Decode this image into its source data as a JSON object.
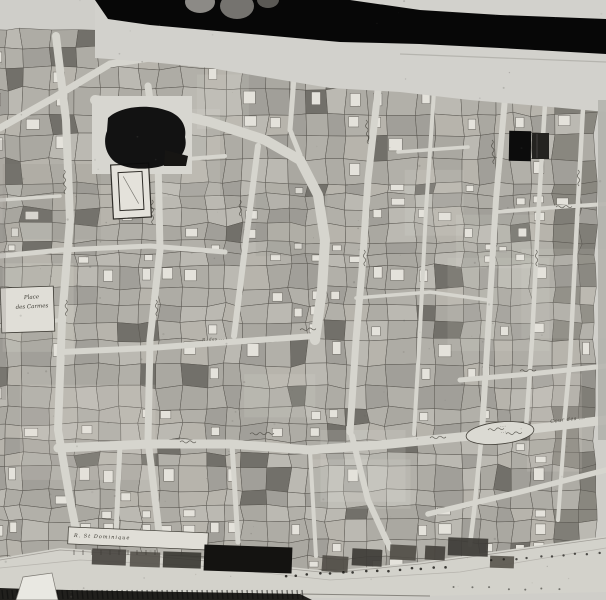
{
  "photo": {
    "description": "Black-and-white photograph of a hand-drawn historical cadastral town plan; a dark band and fingertips obscure the top edge",
    "obstructions": [
      "photo-band-top",
      "fingertips",
      "censor-patch-upper-left",
      "censor-patch-upper-right",
      "censor-patch-bottom"
    ]
  },
  "labels": {
    "place": {
      "line1": "Place",
      "line2": "des Carmes"
    },
    "cour": {
      "text": "Cour des ..."
    },
    "quay_banner": {
      "text": "R. St Dominique"
    },
    "street_1": {
      "text": "R. des ..."
    },
    "cartouche": {
      "line1": "...",
      "line2": "..."
    }
  },
  "features": [
    "parcel-blocks",
    "street-network",
    "place-des-carmes",
    "convent-cloister",
    "quay-esplanade",
    "tree-dot-row",
    "shore-band",
    "paper-corner-wedge"
  ],
  "colors": {
    "paper": "#cfcec9",
    "margin": "#d2d1cc",
    "street": "#d6d5ce",
    "quay": "#d3d2cb",
    "building": "#e4e2db",
    "ink": "#3a3831",
    "censor_black": "#0b0b0b",
    "photo_band": "#070707"
  }
}
